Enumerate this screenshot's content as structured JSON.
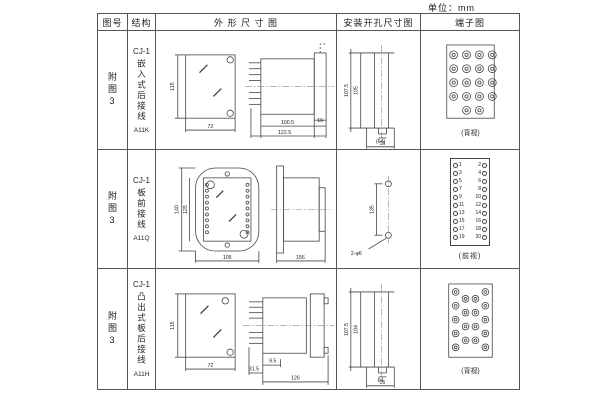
{
  "unit_label": "单位：mm",
  "colors": {
    "line": "#444444",
    "text": "#222222",
    "border": "#555555",
    "background": "#ffffff"
  },
  "table": {
    "headers": {
      "fig": "图号",
      "structure": "结构",
      "outline": "外 形 尺 寸 图",
      "mounting": "安装开孔尺寸图",
      "terminal": "端子图"
    },
    "rows": [
      {
        "fig_no": "附图3",
        "series": "CJ-1",
        "structure_name": "嵌入式后接线",
        "model": "A11K",
        "outline": {
          "front_height": "115",
          "front_width": "72",
          "depth_body": "100.5",
          "depth_total": "122.5",
          "flange": "16"
        },
        "mounting": {
          "outer_height": "107.5",
          "inner_height": "105",
          "tab_width": "16",
          "width": "(64)"
        },
        "terminal": {
          "label": "(背视)",
          "terminal_count": 20,
          "view": "rear"
        }
      },
      {
        "fig_no": "附图3",
        "series": "CJ-1",
        "structure_name": "板前接线",
        "model": "A11Q",
        "outline": {
          "front_height": "140",
          "inner_height": "125",
          "front_width": "105",
          "depth_total": "156"
        },
        "mounting": {
          "hole_distance": "135",
          "holes": "2-φ6"
        },
        "terminal": {
          "label": "(前视)",
          "view": "front",
          "left": [
            "1",
            "3",
            "5",
            "7",
            "9",
            "11",
            "13",
            "15",
            "17",
            "19"
          ],
          "right": [
            "2",
            "4",
            "6",
            "8",
            "10",
            "12",
            "14",
            "16",
            "18",
            "20"
          ]
        }
      },
      {
        "fig_no": "附图3",
        "series": "CJ-1",
        "structure_name": "凸出式板后接线",
        "model": "A11H",
        "outline": {
          "front_height": "115",
          "front_width": "72",
          "pin_length": "31.5",
          "step": "9.5",
          "depth_total": "126"
        },
        "mounting": {
          "outer_height": "107.5",
          "inner_height": "104",
          "tab_width": "16",
          "width": "64"
        },
        "terminal": {
          "label": "(背视)",
          "terminal_count": 18,
          "view": "rear"
        }
      }
    ]
  }
}
